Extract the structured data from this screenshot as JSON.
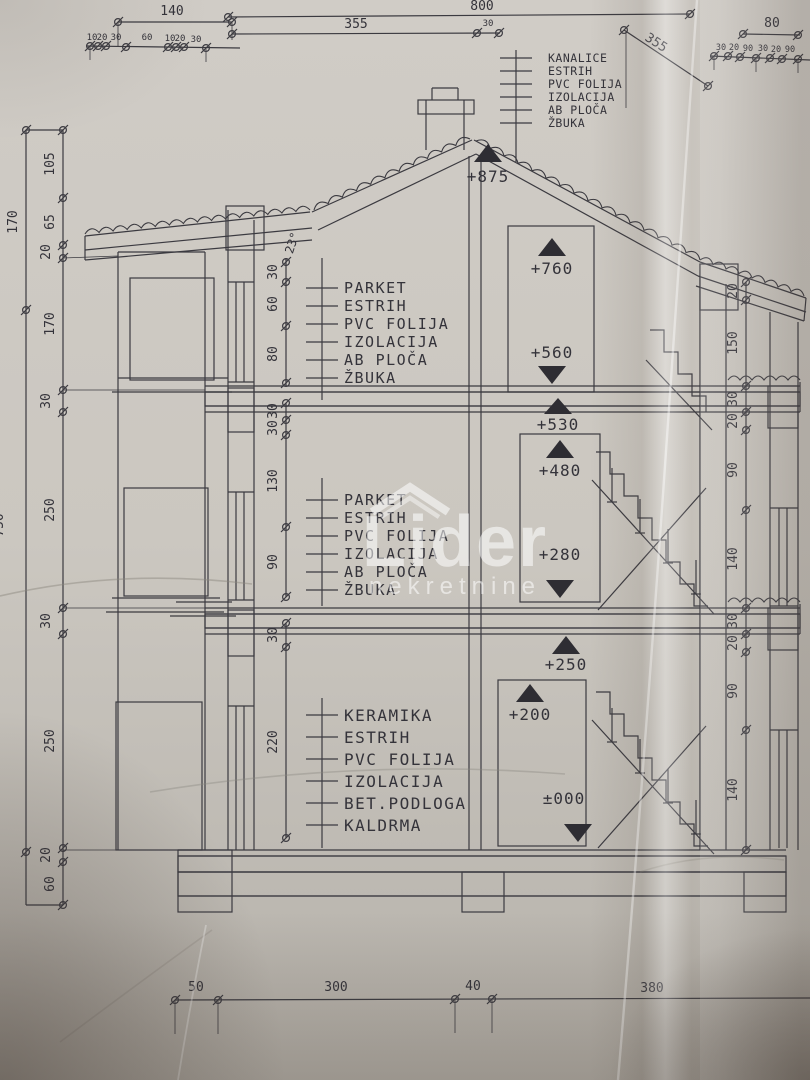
{
  "colors": {
    "paper": "#cbc7c0",
    "ink": "#3b3a40",
    "watermark": "#ffffff"
  },
  "watermark": {
    "title": "Lider",
    "subtitle": "nekretnine"
  },
  "roof": {
    "angle": "23°"
  },
  "elevations": [
    "+875",
    "+760",
    "+560",
    "+530",
    "+480",
    "+280",
    "+250",
    "+200",
    "±000"
  ],
  "materials": {
    "roof": [
      "KANALICE",
      "ESTRIH",
      "PVC FOLIJA",
      "IZOLACIJA",
      "AB PLOČA",
      "ŽBUKA"
    ],
    "top_floor": [
      "PARKET",
      "ESTRIH",
      "PVC FOLIJA",
      "IZOLACIJA",
      "AB PLOČA",
      "ŽBUKA"
    ],
    "middle_floor": [
      "PARKET",
      "ESTRIH",
      "PVC FOLIJA",
      "IZOLACIJA",
      "AB PLOČA",
      "ŽBUKA"
    ],
    "ground_floor": [
      "KERAMIKA",
      "ESTRIH",
      "PVC FOLIJA",
      "IZOLACIJA",
      "BET.PODLOGA",
      "KALDRMA"
    ]
  },
  "dims": {
    "top_140": "140",
    "top_small_left": [
      "10",
      "20",
      "30",
      "60",
      "10",
      "20",
      "30"
    ],
    "top_800": "800",
    "top_30": "30",
    "top_355_left": "355",
    "top_355_fold": "355",
    "top_80": "80",
    "top_small_right": [
      "30",
      "20",
      "90",
      "30",
      "20",
      "90"
    ],
    "left_outer": [
      "170",
      "750"
    ],
    "left_inner": [
      "105",
      "65",
      "20",
      "170",
      "30",
      "250",
      "30",
      "250",
      "20",
      "60"
    ],
    "interior": [
      "30",
      "60",
      "80",
      "30",
      "30",
      "130",
      "90",
      "30",
      "220"
    ],
    "right": [
      "20",
      "150",
      "30",
      "20",
      "90",
      "140",
      "30",
      "20",
      "90",
      "140"
    ],
    "bottom": [
      "50",
      "300",
      "40",
      "380"
    ]
  }
}
